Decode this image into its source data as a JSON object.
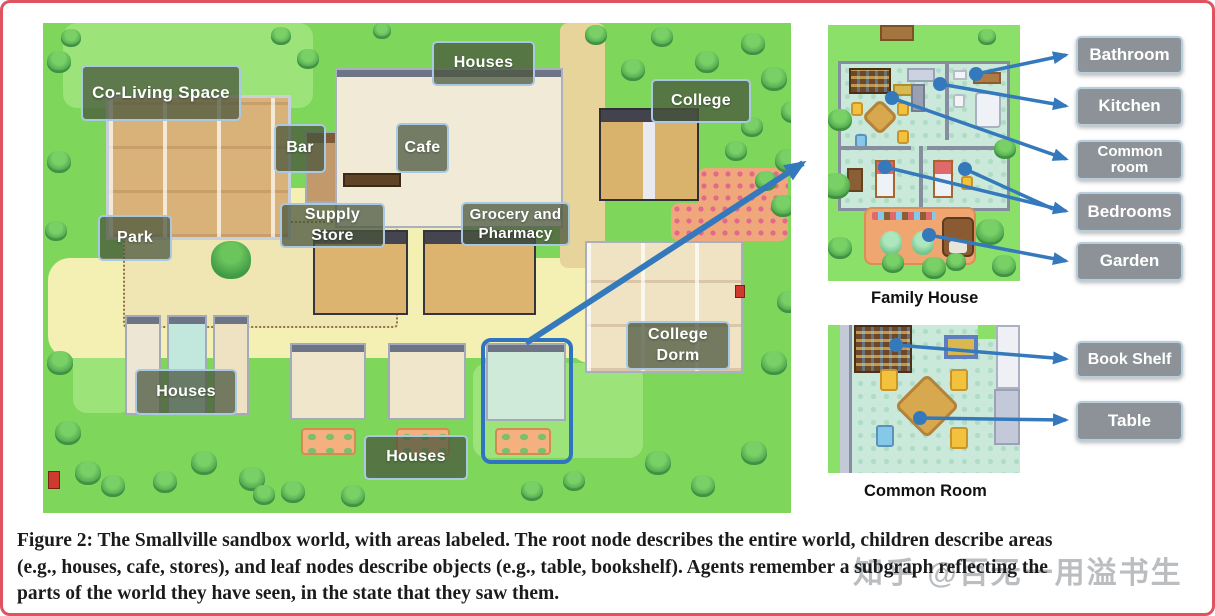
{
  "figure": {
    "caption": {
      "lines": [
        "Figure 2: The Smallville sandbox world, with areas labeled. The root node describes the entire world, children describe areas",
        "(e.g., houses, cafe, stores), and leaf nodes describe objects (e.g., table, bookshelf). Agents remember a subgraph reflecting the",
        "parts of the world they have seen, in the state that they saw them."
      ]
    },
    "watermark": "知乎 @百无一用溢书生"
  },
  "map": {
    "labels": {
      "coliving": "Co-Living Space",
      "houses_top": "Houses",
      "bar": "Bar",
      "cafe": "Cafe",
      "college": "College",
      "supply_store": "Supply Store",
      "grocery_pharmacy": "Grocery and Pharmacy",
      "park": "Park",
      "college_dorm": "College Dorm",
      "houses_left": "Houses",
      "houses_bottom": "Houses"
    }
  },
  "insets": {
    "family_house": {
      "caption": "Family House",
      "labels": [
        "Bathroom",
        "Kitchen",
        "Common room",
        "Bedrooms",
        "Garden"
      ]
    },
    "common_room": {
      "caption": "Common Room",
      "labels": [
        "Book Shelf",
        "Table"
      ]
    }
  },
  "colors": {
    "arrow_blue": "#3579bd",
    "map_label_bg": "rgba(73,85,61,0.74)",
    "map_label_border": "#a9c9e2",
    "gray_label_bg": "#8d9298",
    "frame_red": "#e0525f"
  }
}
